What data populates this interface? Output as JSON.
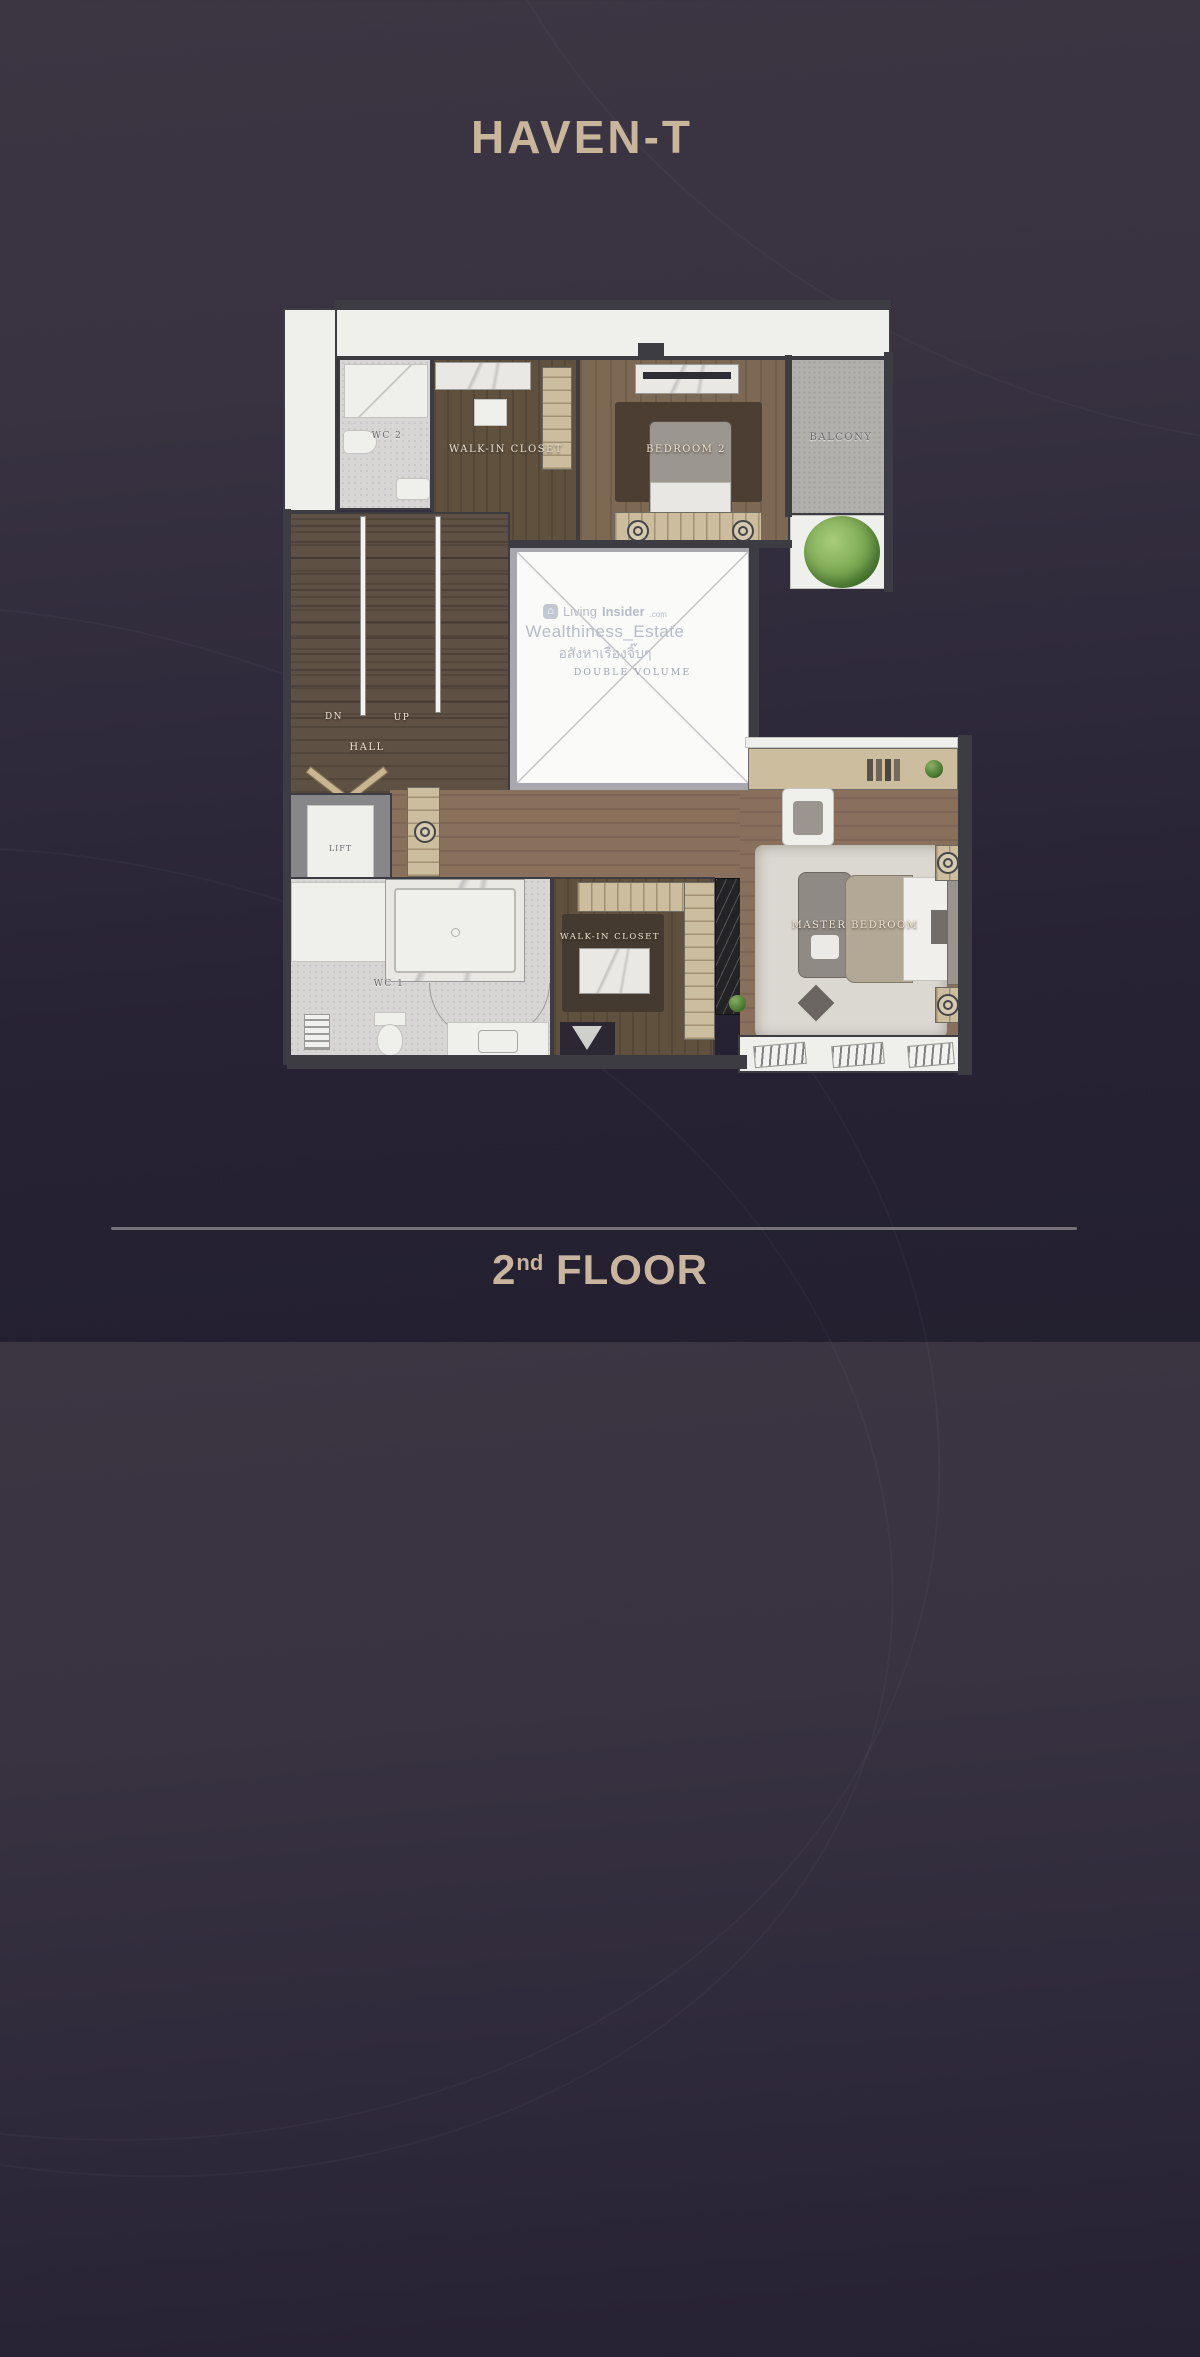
{
  "header": {
    "title": "HAVEN-T"
  },
  "watermark": {
    "logo_glyph": "⌂",
    "brand": "Living",
    "brand_bold": "Insider",
    "tld": ".com",
    "line2": "Wealthiness_Estate",
    "line3": "อสังหาเรื่องจิ๊บๆ"
  },
  "plan": {
    "labels": {
      "wc2": "WC 2",
      "walkin_closet_top": "WALK-IN CLOSET",
      "bedroom2": "BEDROOM 2",
      "balcony": "BALCONY",
      "dn": "DN",
      "up": "UP",
      "hall": "HALL",
      "double_volume": "DOUBLE VOLUME",
      "lift": "LIFT",
      "wc1": "WC 1",
      "walkin_closet_master": "WALK-IN CLOSET",
      "master_bedroom": "MASTER BEDROOM"
    },
    "colors": {
      "background_top": "#3c3643",
      "background_bottom": "#232030",
      "accent_text": "#c9b59a",
      "wall": "#3d3c42",
      "wood_floor": "#7d6854",
      "wood_dark": "#5f5044",
      "tile": "#d7d6d4",
      "balcony_concrete": "#b2b0ad",
      "wardrobe_tan": "#ccbd9e",
      "rug": "#dbd8d1",
      "tree_green": "#78a650",
      "divider_line": "#76717b"
    }
  },
  "footer": {
    "floor_number": "2",
    "floor_ordinal": "nd",
    "floor_label": "FLOOR"
  }
}
